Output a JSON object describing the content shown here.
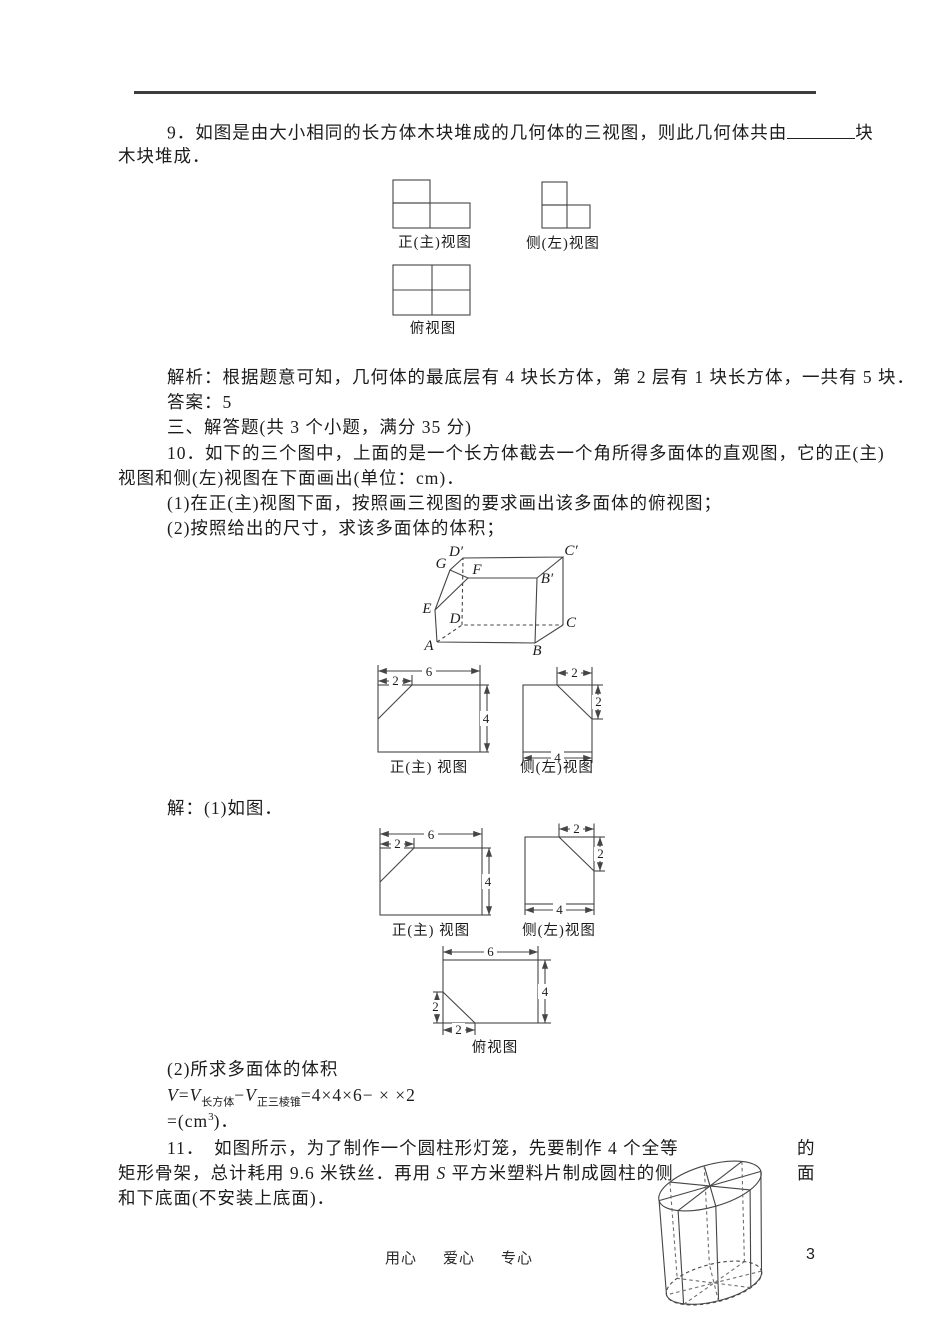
{
  "page": {
    "number": "3",
    "footer_words": [
      "用心",
      "爱心",
      "专心"
    ]
  },
  "q9": {
    "line1_pre": "9．如图是由大小相同的长方体木块堆成的几何体的三视图，则此几何体共由",
    "line1_post": "块",
    "line2": "木块堆成．",
    "views": {
      "front": "正(主)视图",
      "side": "侧(左)视图",
      "top": "俯视图"
    },
    "analysis": "解析：根据题意可知，几何体的最底层有 4 块长方体，第 2 层有 1 块长方体，一共有 5 块．",
    "answer": "答案：5"
  },
  "section3_heading": "三、解答题(共 3 个小题，满分 35 分)",
  "q10": {
    "line1": "10．如下的三个图中，上面的是一个长方体截去一个角所得多面体的直观图，它的正(主)",
    "line2": "视图和侧(左)视图在下面画出(单位：cm)．",
    "item1": "(1)在正(主)视图下面，按照画三视图的要求画出该多面体的俯视图；",
    "item2": "(2)按照给出的尺寸，求该多面体的体积；",
    "vertices": {
      "A": "A",
      "B": "B",
      "C": "C",
      "D": "D",
      "E": "E",
      "F": "F",
      "G": "G",
      "B1": "B′",
      "C1": "C′",
      "D1": "D′"
    },
    "dims": {
      "six": "6",
      "four": "4",
      "two": "2"
    },
    "front_label": "正(主) 视图",
    "side_label": "侧(左)视图",
    "top_label": "俯视图",
    "solution": "解：(1)如图．",
    "part2_title": "(2)所求多面体的体积",
    "formula": {
      "v": "V",
      "eq": "=",
      "sub_cuboid": "长方体",
      "minus": "−",
      "sub_pyramid": "正三棱锥",
      "tail": "=4×4×6− × ×2"
    },
    "result": {
      "pre": "=(cm",
      "sup": "3",
      "post": ")．"
    }
  },
  "q11": {
    "line1": "11．　如图所示，为了制作一个圆柱形灯笼，先要制作 4 个全等",
    "line1_hang": "的",
    "line2_pre": "矩形骨架，总计耗用 9.6 米铁丝．再用 ",
    "line2_s": "S",
    "line2_post": " 平方米塑料片制成圆柱的侧",
    "line2_hang": "面",
    "line3": "和下底面(不安装上底面)．"
  }
}
